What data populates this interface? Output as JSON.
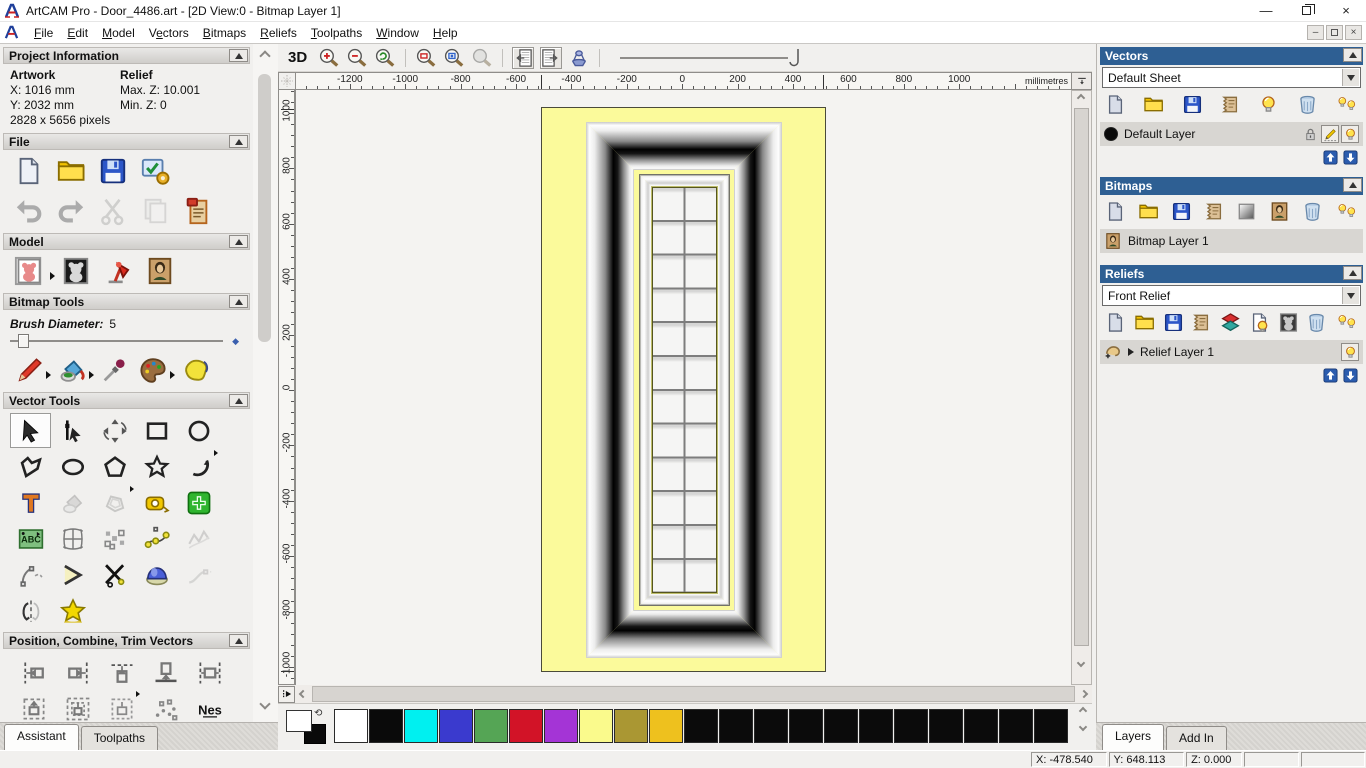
{
  "window": {
    "title": "ArtCAM Pro - Door_4486.art - [2D View:0 - Bitmap Layer 1]",
    "controls": {
      "minimize": "minimize",
      "restore": "restore",
      "close": "close"
    }
  },
  "menu": {
    "items": [
      {
        "label": "File",
        "accel": 0
      },
      {
        "label": "Edit",
        "accel": 0
      },
      {
        "label": "Model",
        "accel": 0
      },
      {
        "label": "Vectors",
        "accel": 1
      },
      {
        "label": "Bitmaps",
        "accel": 0
      },
      {
        "label": "Reliefs",
        "accel": 0
      },
      {
        "label": "Toolpaths",
        "accel": 0
      },
      {
        "label": "Window",
        "accel": 0
      },
      {
        "label": "Help",
        "accel": 0
      }
    ]
  },
  "assistant": {
    "tabs": [
      {
        "label": "Assistant",
        "active": true
      },
      {
        "label": "Toolpaths",
        "active": false
      }
    ],
    "project": {
      "title": "Project Information",
      "artwork_label": "Artwork",
      "relief_label": "Relief",
      "x": "X: 1016 mm",
      "y": "Y: 2032 mm",
      "max_z": "Max. Z: 10.001",
      "min_z": "Min. Z: 0",
      "pixels": "2828 x 5656 pixels"
    },
    "file_section": {
      "title": "File",
      "row1": [
        {
          "name": "new-model-icon"
        },
        {
          "name": "open-model-icon"
        },
        {
          "name": "save-model-icon"
        },
        {
          "name": "model-properties-icon"
        }
      ],
      "row2": [
        {
          "name": "undo-icon"
        },
        {
          "name": "redo-icon"
        },
        {
          "name": "cut-icon",
          "disabled": true
        },
        {
          "name": "paste-icon",
          "disabled": true
        },
        {
          "name": "notes-icon"
        }
      ]
    },
    "model_section": {
      "title": "Model",
      "row": [
        {
          "name": "set-model-size-icon",
          "flyout": true
        },
        {
          "name": "invert-model-icon"
        },
        {
          "name": "lighting-icon"
        },
        {
          "name": "load-bitmap-icon"
        }
      ]
    },
    "bitmap_tools": {
      "title": "Bitmap Tools",
      "brush_label": "Brush Diameter:",
      "brush_value": "5",
      "row": [
        {
          "name": "paint-brush-icon",
          "flyout": true
        },
        {
          "name": "flood-fill-icon",
          "flyout": true
        },
        {
          "name": "colour-picker-icon"
        },
        {
          "name": "palette-icon",
          "flyout": true
        },
        {
          "name": "texture-icon"
        }
      ]
    },
    "vector_tools": {
      "title": "Vector Tools",
      "grid": [
        {
          "name": "select-vectors-icon",
          "pressed": true
        },
        {
          "name": "node-editing-icon"
        },
        {
          "name": "transform-vectors-icon"
        },
        {
          "name": "rectangle-tool-icon"
        },
        {
          "name": "circle-tool-icon"
        },
        {
          "name": "polyline-tool-icon"
        },
        {
          "name": "ellipse-tool-icon"
        },
        {
          "name": "polygon-tool-icon"
        },
        {
          "name": "star-tool-icon"
        },
        {
          "name": "arc-tool-icon",
          "flyout": true
        },
        {
          "name": "text-tool-icon"
        },
        {
          "name": "vector-paint-icon",
          "disabled": true
        },
        {
          "name": "offset-vectors-icon",
          "disabled": true,
          "flyout": true
        },
        {
          "name": "measure-tool-icon"
        },
        {
          "name": "nesting-icon"
        },
        {
          "name": "text-block-icon"
        },
        {
          "name": "envelope-distort-icon"
        },
        {
          "name": "block-paste-icon"
        },
        {
          "name": "fit-curve-icon"
        },
        {
          "name": "simplify-vectors-icon",
          "disabled": true
        },
        {
          "name": "fit-arcs-icon"
        },
        {
          "name": "bisector-icon"
        },
        {
          "name": "trim-vectors-icon"
        },
        {
          "name": "blend-spans-icon"
        },
        {
          "name": "extend-curve-icon",
          "disabled": true
        },
        {
          "name": "mirror-vectors-icon"
        },
        {
          "name": "vector-doctor-icon"
        }
      ]
    },
    "position_section": {
      "title": "Position, Combine, Trim Vectors",
      "grid": [
        {
          "name": "align-left-icon"
        },
        {
          "name": "align-right-icon"
        },
        {
          "name": "align-top-icon"
        },
        {
          "name": "align-bottom-icon"
        },
        {
          "name": "align-centre-icon"
        },
        {
          "name": "centre-in-page-icon"
        },
        {
          "name": "centre-in-rect-icon"
        },
        {
          "name": "paste-in-position-icon",
          "flyout": true
        },
        {
          "name": "scatter-copies-icon"
        },
        {
          "name": "nesting-text-icon"
        }
      ]
    }
  },
  "view": {
    "toolbar": {
      "label_3d": "3D",
      "zoom_group": [
        {
          "name": "zoom-in-icon"
        },
        {
          "name": "zoom-out-icon"
        },
        {
          "name": "zoom-previous-icon"
        }
      ],
      "zoom_group2": [
        {
          "name": "zoom-rect-icon"
        },
        {
          "name": "zoom-object-icon"
        },
        {
          "name": "zoom-limits-icon",
          "disabled": true
        }
      ],
      "toggle_group": [
        {
          "name": "prev-bitmap-icon",
          "pressed": true
        },
        {
          "name": "next-bitmap-icon",
          "pressed": true
        },
        {
          "name": "fade-bitmap-icon"
        }
      ]
    },
    "hruler": {
      "labels": [
        "-1200",
        "-1000",
        "-800",
        "-600",
        "-400",
        "-200",
        "0",
        "200",
        "400",
        "600",
        "800",
        "1000"
      ],
      "unit": "millimetres"
    },
    "vruler": {
      "labels": [
        "1000",
        "800",
        "600",
        "400",
        "200",
        "0",
        "-200",
        "-400",
        "-600",
        "-800",
        "-1000"
      ]
    }
  },
  "palette": {
    "primary": "#ffffff",
    "secondary": "#0a0a0a",
    "swatches": [
      "#ffffff",
      "#0a0a0a",
      "#00f0f0",
      "#3a3ace",
      "#55a555",
      "#d21327",
      "#a434d6",
      "#fafa8c",
      "#aa9733",
      "#eec11e",
      "#0b0b0b",
      "#0b0b0b",
      "#0b0b0b",
      "#0b0b0b",
      "#0b0b0b",
      "#0b0b0b",
      "#0b0b0b",
      "#0b0b0b",
      "#0b0b0b",
      "#0b0b0b",
      "#0b0b0b"
    ]
  },
  "layers_panel": {
    "vectors": {
      "title": "Vectors",
      "sheet": "Default Sheet",
      "toolbar": [
        {
          "name": "new-sheet-icon"
        },
        {
          "name": "open-layers-icon"
        },
        {
          "name": "save-layers-icon"
        },
        {
          "name": "merge-layers-icon"
        },
        {
          "name": "visibility-bulb-icon"
        },
        {
          "name": "delete-layer-icon"
        },
        {
          "name": "all-visibility-icon"
        }
      ],
      "layer": {
        "name": "Default Layer",
        "color": "#0a0a0a"
      },
      "layer_buttons": [
        {
          "name": "lock-layer-icon"
        },
        {
          "name": "edit-layer-icon",
          "framed": true
        },
        {
          "name": "layer-bulb-icon",
          "framed": true
        }
      ]
    },
    "bitmaps": {
      "title": "Bitmaps",
      "toolbar": [
        {
          "name": "new-bitmap-layer-icon"
        },
        {
          "name": "open-layers-icon"
        },
        {
          "name": "save-layers-icon"
        },
        {
          "name": "merge-layers-icon"
        },
        {
          "name": "greyscale-icon"
        },
        {
          "name": "bitmap-preview-icon"
        },
        {
          "name": "delete-layer-icon"
        },
        {
          "name": "all-visibility-icon"
        }
      ],
      "layer": {
        "name": "Bitmap Layer 1"
      }
    },
    "reliefs": {
      "title": "Reliefs",
      "combo": "Front Relief",
      "toolbar": [
        {
          "name": "new-relief-layer-icon"
        },
        {
          "name": "open-layers-icon"
        },
        {
          "name": "save-layers-icon"
        },
        {
          "name": "merge-layers-icon"
        },
        {
          "name": "colour-stack-icon"
        },
        {
          "name": "bulb-page-icon"
        },
        {
          "name": "relief-preview-icon"
        },
        {
          "name": "delete-layer-icon"
        },
        {
          "name": "all-visibility-icon"
        }
      ],
      "layer": {
        "name": "Relief Layer 1"
      }
    },
    "tabs": [
      {
        "label": "Layers",
        "active": true
      },
      {
        "label": "Add In",
        "active": false
      }
    ]
  },
  "status": {
    "x": "X: -478.540",
    "y": "Y: 648.113",
    "z": "Z: 0.000"
  }
}
